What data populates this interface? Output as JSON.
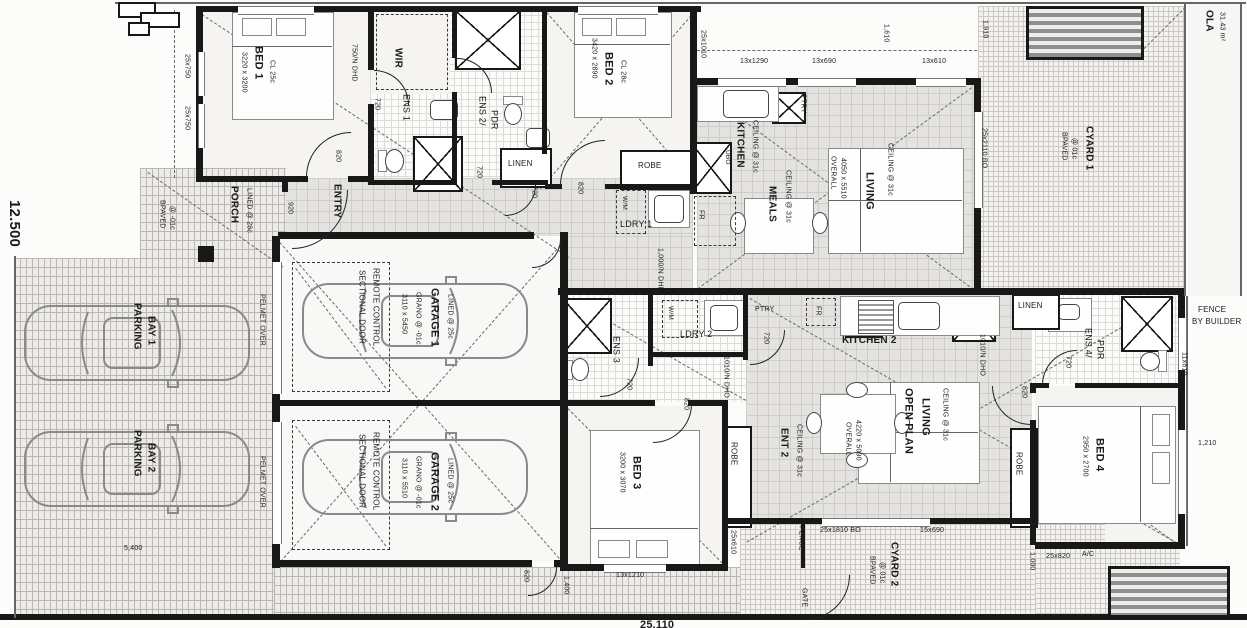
{
  "site": {
    "boundary_width": "12.500",
    "bottom_total": "25.110",
    "dr_dim": "5,400",
    "top_dims": {
      "w_left": "25x1010",
      "w1": "13x1290",
      "w2": "13x690",
      "gap": "1,610",
      "w3": "13x610",
      "side": "1,910",
      "door": "25x2110 BO"
    },
    "left_dims": {
      "w1": "25x750",
      "w2": "25x750"
    },
    "right": {
      "fence1": "FENCE",
      "fence2": "BY BUILDER",
      "w_ens4": "11x610",
      "gap": "1,210"
    },
    "bottom": {
      "gap1": "1,400",
      "w_bed3": "13x1210",
      "w_ens": "25x610",
      "fence": "FENCE",
      "gate": "GATE",
      "door": "25x1810 BO",
      "w2": "15x690",
      "gap2": "1,000",
      "w_bed4": "25x820",
      "ac": "A/C"
    },
    "ola": {
      "title": "OLA",
      "area": "31.43 m²"
    }
  },
  "outdoor": {
    "porch": {
      "name": "PORCH",
      "lining": "LINED @ 28c",
      "paving1": "BPAVED",
      "paving2": "@ -01c",
      "door": "920"
    },
    "parking": {
      "bay1_l1": "PARKING",
      "bay1_l2": "BAY 1",
      "bay2_l1": "PARKING",
      "bay2_l2": "BAY 2",
      "pelmet": "PELMET OVER"
    },
    "cyard1": {
      "name": "CYARD 1",
      "paving1": "BPAVED",
      "paving2": "@ 01c"
    },
    "cyard2": {
      "name": "CYARD 2",
      "paving1": "BPAVED",
      "paving2": "@ 01c"
    }
  },
  "unit1": {
    "bed1": {
      "name": "BED 1",
      "size": "3220 x 3200",
      "ceiling": "CL 25c",
      "door": "820"
    },
    "wir": {
      "name": "WIR"
    },
    "ens1": {
      "name": "ENS 1",
      "door": "720"
    },
    "ens2": {
      "name_l1": "ENS 2/",
      "name_l2": "PDR",
      "door": "720"
    },
    "linen": {
      "name": "LINEN",
      "door": "720"
    },
    "bed2": {
      "name": "BED 2",
      "size": "3420 x 2890",
      "ceiling": "CL 28c",
      "door": "820"
    },
    "robe": {
      "name": "ROBE"
    },
    "ldry1": {
      "name": "LDRY 1",
      "wm": "W/M",
      "note": "1,000/N DHD"
    },
    "fr": "FR",
    "entry": {
      "name": "ENTRY",
      "note": "750/N DHD"
    },
    "kitchen": {
      "name": "KITCHEN",
      "ceiling": "CEILING @ 31c",
      "ptry": "PTRY",
      "ubo": "UBO"
    },
    "meals": {
      "name": "MEALS",
      "ceiling": "CEILING @ 31c"
    },
    "living": {
      "name": "LIVING",
      "ceiling": "CEILING @ 31c",
      "overall": "OVERALL",
      "size": "4050 x 5510"
    },
    "garage1": {
      "name": "GARAGE 1",
      "size": "3110 x 5450",
      "lining": "LINED @ 25c",
      "floor": "GRANO @ -01c",
      "door_l1": "REMOTE CONTROL",
      "door_l2": "SECTIONAL DOOR"
    }
  },
  "unit2": {
    "garage2": {
      "name": "GARAGE 2",
      "size": "3110 x 5510",
      "lining": "LINED @ 25c",
      "floor": "GRANO @ -01c",
      "door_l1": "REMOTE CONTROL",
      "door_l2": "SECTIONAL DOOR",
      "rear_door": "820"
    },
    "ens3": {
      "name": "ENS 3",
      "door": "720"
    },
    "ldry2": {
      "name": "LDRY 2",
      "wm": "W/M",
      "door": "720"
    },
    "ptry": "PTRY",
    "fr": "FR",
    "ent2": {
      "name": "ENT 2",
      "ceiling": "CEILING @ 31c",
      "note": "1010/N DHO",
      "door": "820"
    },
    "kitchen2": {
      "name": "KITCHEN 2"
    },
    "openplan": {
      "name_l1": "OPEN PLAN",
      "name_l2": "LIVING",
      "ceiling": "CEILING @ 31c",
      "overall": "OVERALL",
      "size": "4220 x 5090",
      "note": "1010/N DHO"
    },
    "linen": {
      "name": "LINEN"
    },
    "ens4": {
      "name_l1": "ENS 4/",
      "name_l2": "PDR",
      "door": "720"
    },
    "bed3": {
      "name": "BED 3",
      "size": "3200 x 3070",
      "door": "820",
      "robe": "ROBE"
    },
    "bed4": {
      "name": "BED 4",
      "size": "2950 x 2700",
      "robe": "ROBE"
    }
  }
}
